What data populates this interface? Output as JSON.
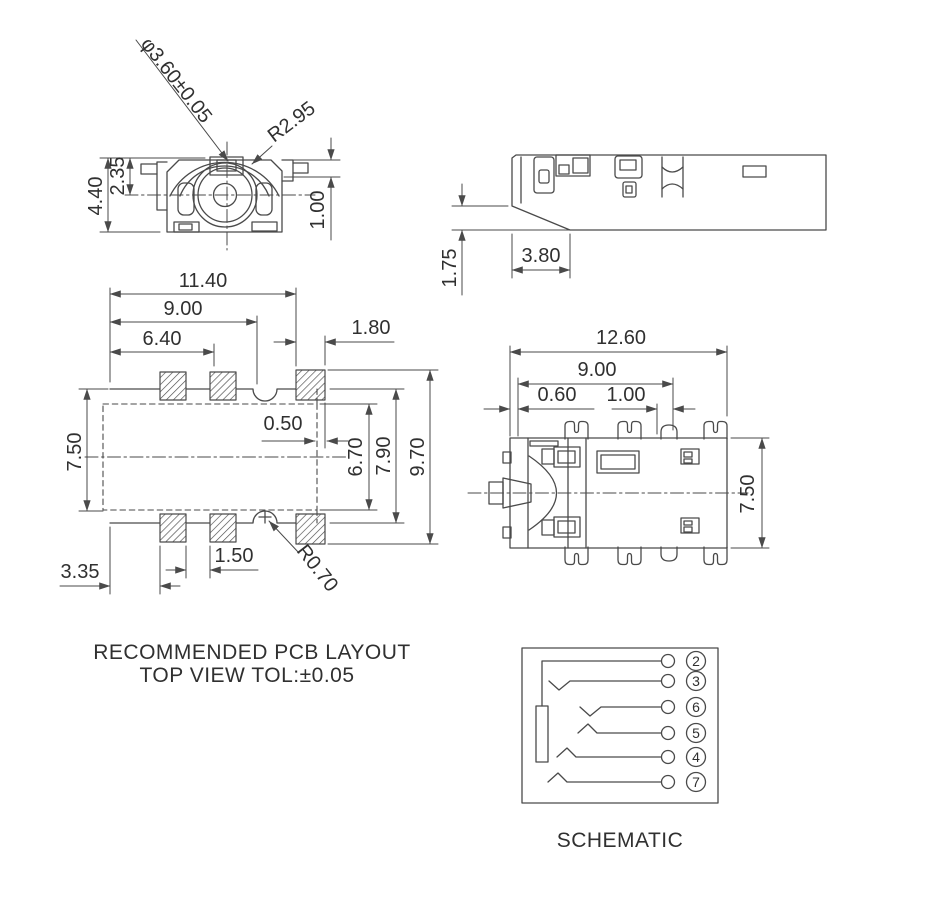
{
  "colors": {
    "line": "#4a4a4a",
    "text": "#303030",
    "background": "#ffffff"
  },
  "front_view": {
    "diameter_label": "φ3.60±0.05",
    "radius_label": "R2.95",
    "overall_height": "4.40",
    "center_height": "2.35",
    "step_height": "1.00"
  },
  "side_view": {
    "foot_height": "1.75",
    "chamfer_length": "3.80"
  },
  "pcb_layout": {
    "overall_width": "11.40",
    "inner_width": "9.00",
    "pad_span": "6.40",
    "pad_width": "1.80",
    "edge_gap": "0.50",
    "inner_height": "6.70",
    "outline_height": "7.90",
    "overall_height": "9.70",
    "body_height": "7.50",
    "pad_gap": "1.50",
    "pad_offset": "3.35",
    "notch_radius": "R0.70",
    "caption_line1": "RECOMMENDED PCB LAYOUT",
    "caption_line2": "TOP VIEW TOL:±0.05"
  },
  "bottom_view": {
    "overall_width": "12.60",
    "pin_span": "9.00",
    "edge_offset": "0.60",
    "pin_pitch": "1.00",
    "body_height": "7.50"
  },
  "schematic": {
    "caption": "SCHEMATIC",
    "pins": [
      {
        "label": "2"
      },
      {
        "label": "3"
      },
      {
        "label": "6"
      },
      {
        "label": "5"
      },
      {
        "label": "4"
      },
      {
        "label": "7"
      }
    ]
  }
}
